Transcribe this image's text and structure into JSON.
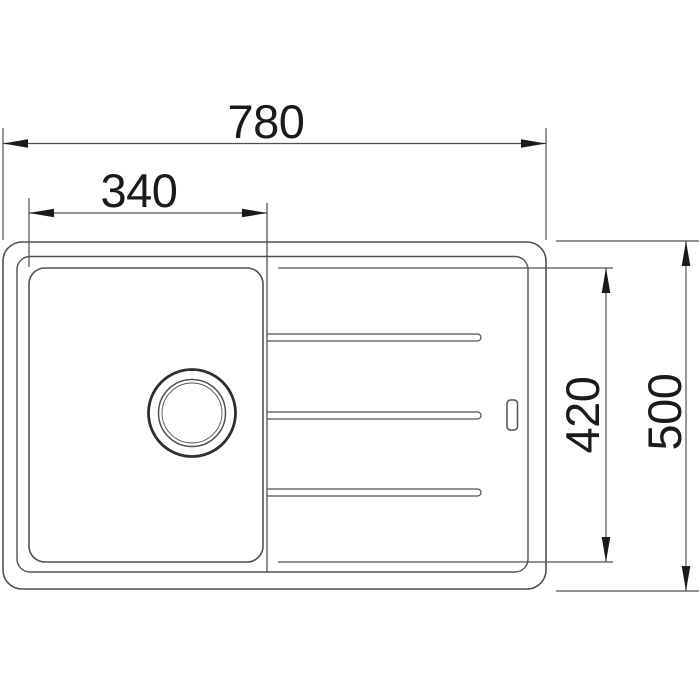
{
  "diagram": {
    "subject": "kitchen-sink-top-view-technical-drawing",
    "background": "#ffffff",
    "line_color": "#515151",
    "ink_color": "#1a1a1a",
    "dims": {
      "overall_width": "780",
      "bowl_width": "340",
      "inner_depth": "420",
      "overall_depth": "500"
    },
    "features": {
      "outer_rim": "sink outer edge",
      "inner_rim": "sink inner rim",
      "bowl": "main bowl",
      "drain": "drain hole",
      "tap_hole": "tap hole",
      "drainer_ridges": "3 drainer ridges"
    }
  }
}
